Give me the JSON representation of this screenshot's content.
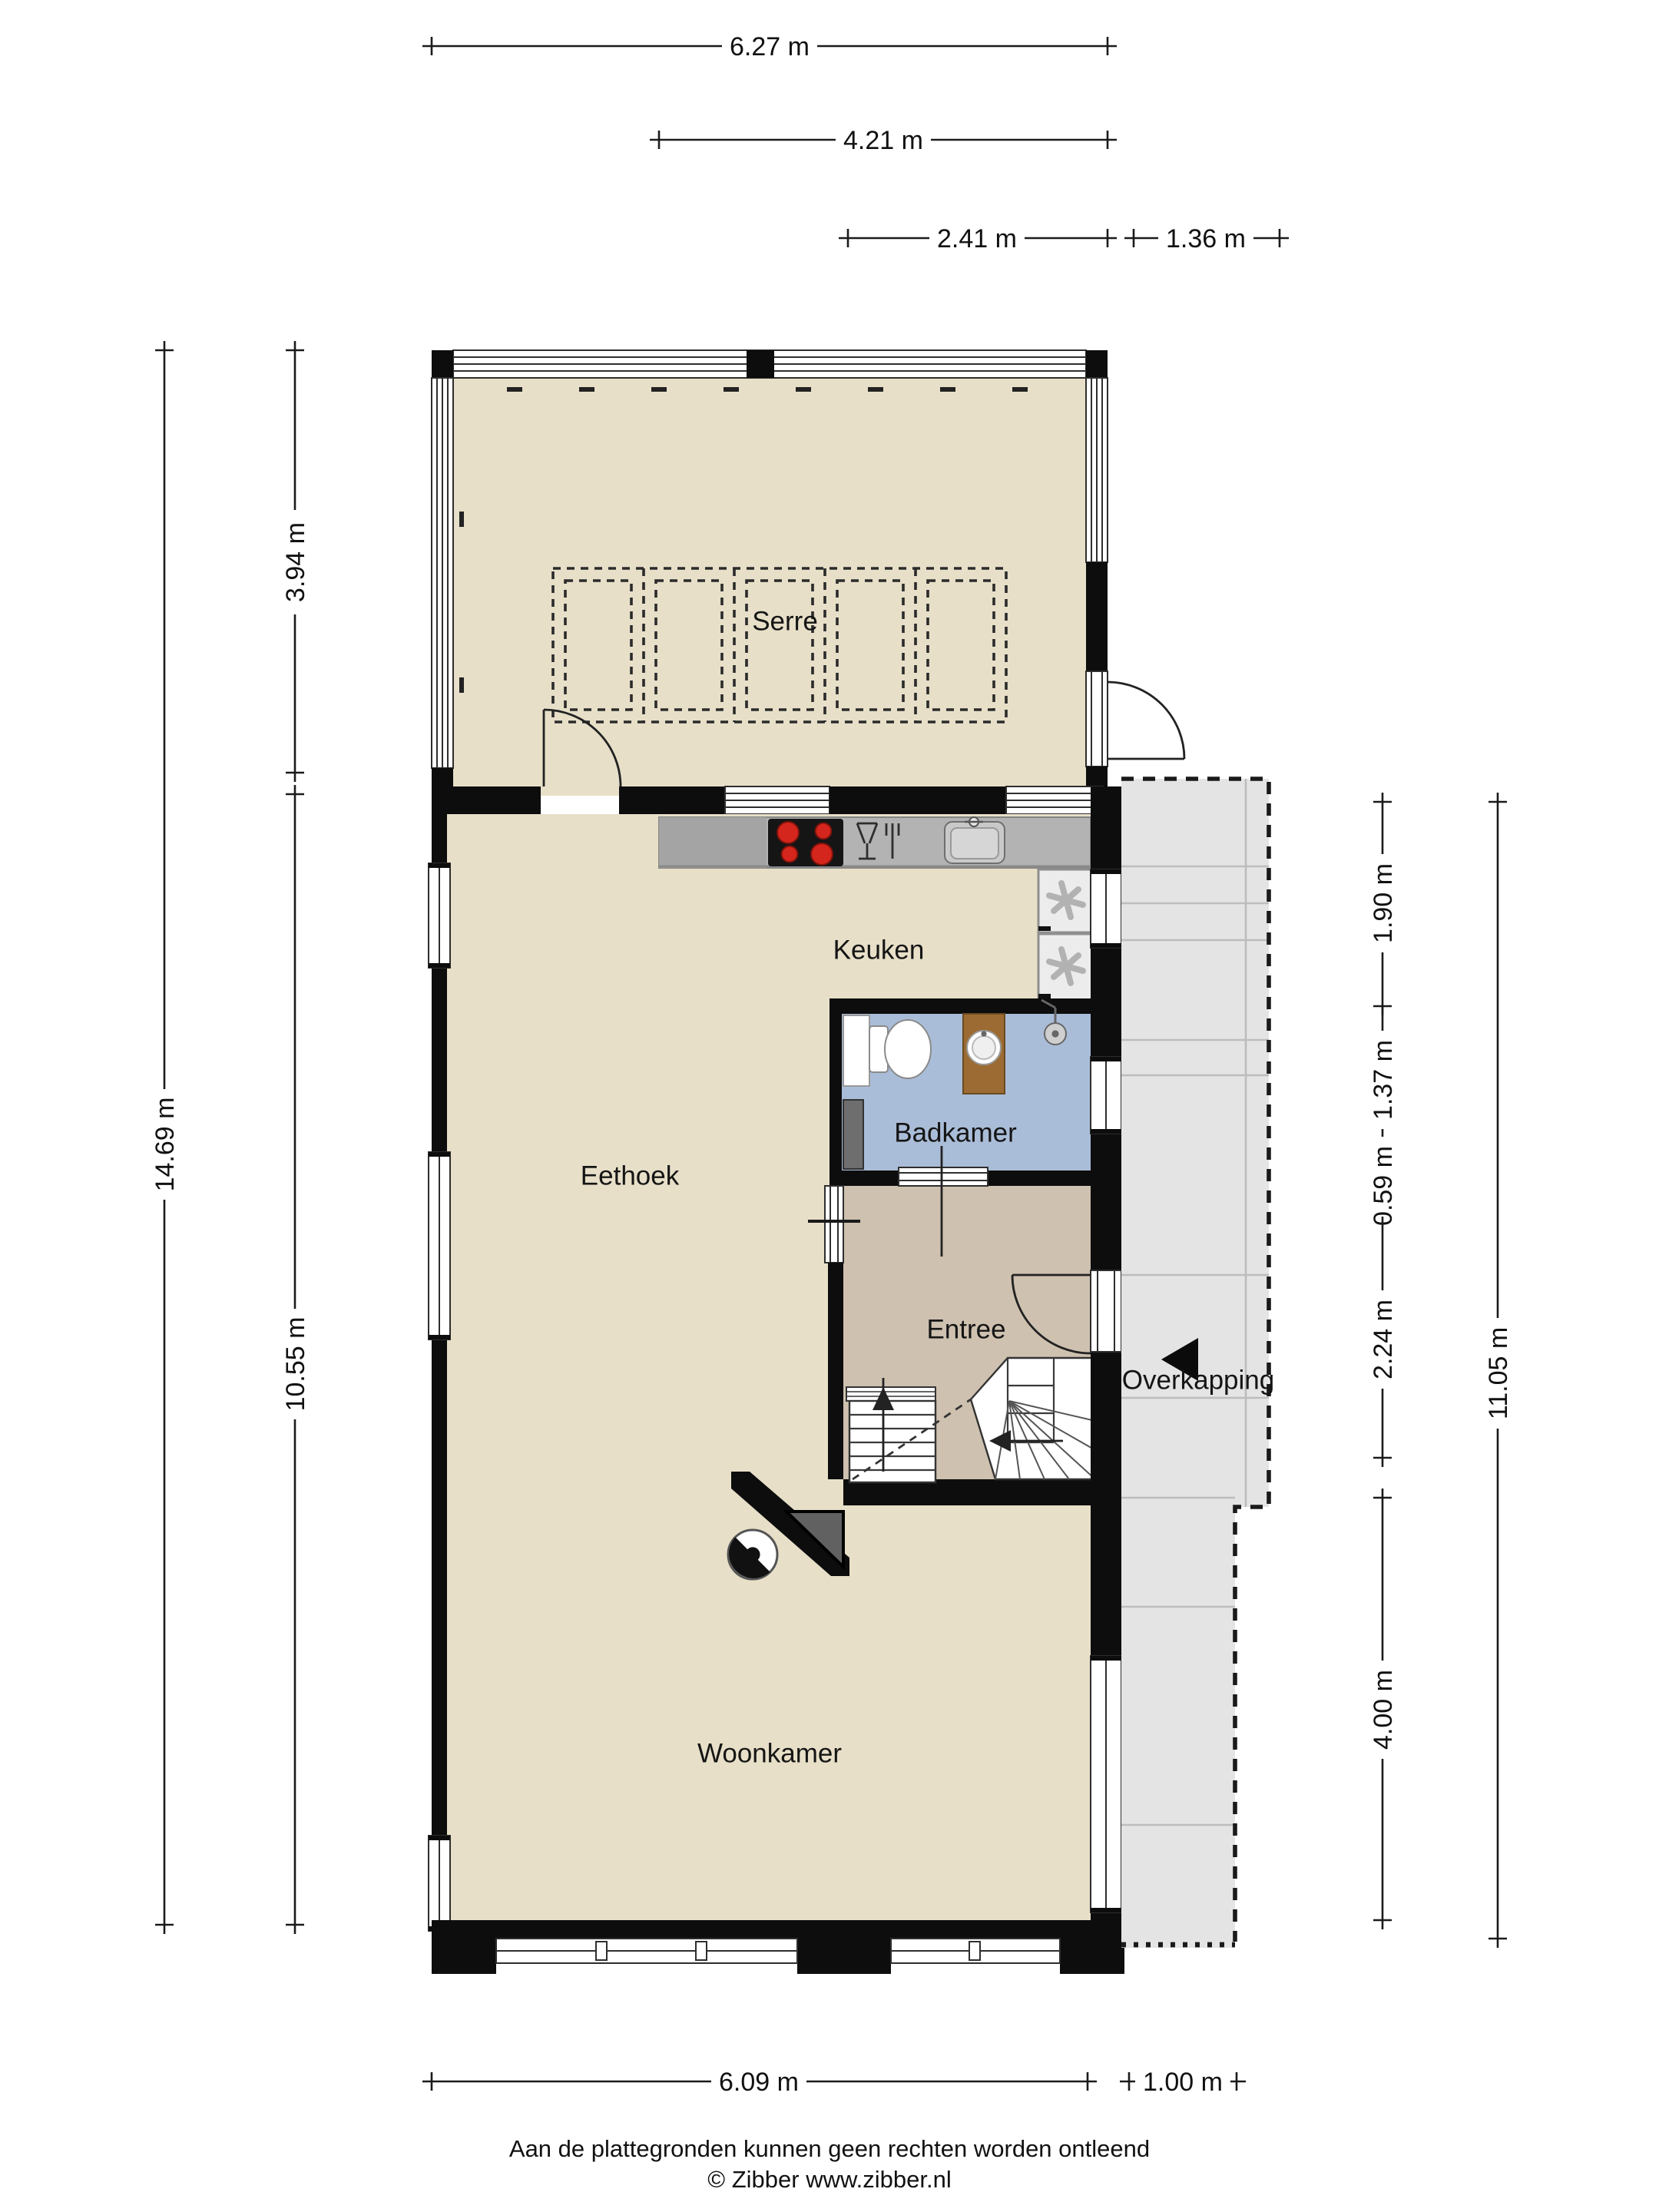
{
  "document": {
    "type": "floor-plan",
    "footer_disclaimer": "Aan de plattegronden kunnen geen rechten worden ontleend",
    "footer_credit": "© Zibber www.zibber.nl"
  },
  "rooms": {
    "serre": "Serre",
    "keuken": "Keuken",
    "badkamer": "Badkamer",
    "eethoek": "Eethoek",
    "entree": "Entree",
    "overkapping": "Overkapping",
    "woonkamer": "Woonkamer"
  },
  "dimensions": {
    "top": [
      "6.27 m",
      "4.21 m",
      "2.41 m",
      "1.36 m"
    ],
    "left": [
      "14.69 m",
      "3.94 m",
      "10.55 m"
    ],
    "right": [
      "1.90 m",
      "1.37 m",
      "0.59 m",
      "2.24 m",
      "4.00 m",
      "11.05 m"
    ],
    "bottom": [
      "6.09 m",
      "1.00 m"
    ]
  },
  "icons": {
    "stove": "cooktop-4-burners",
    "dishwasher": "glass-and-fork",
    "sink": "kitchen-sink-with-tap",
    "fridge_freezer": "two-appliances-fan-symbol",
    "toilet": "toilet",
    "washbasin": "wood-vanity-round-basin",
    "shower": "shower-head",
    "smoke_detector": "round-detector",
    "stairs_up_arrow": "arrow-up",
    "stairs_turn_arrow": "arrow-left",
    "entrance_arrow": "solid-triangle-left"
  },
  "colors": {
    "floor_main": "#e7dfc8",
    "floor_entree": "#cec1b0",
    "floor_badkamer": "#aabdd8",
    "overkapping_fill": "#e4e4e4",
    "counter": "#b3b3b3",
    "cooktop": "#151515",
    "burner_red": "#d4261c",
    "vanity_wood": "#9c6b33",
    "wall": "#0d0d0d"
  }
}
